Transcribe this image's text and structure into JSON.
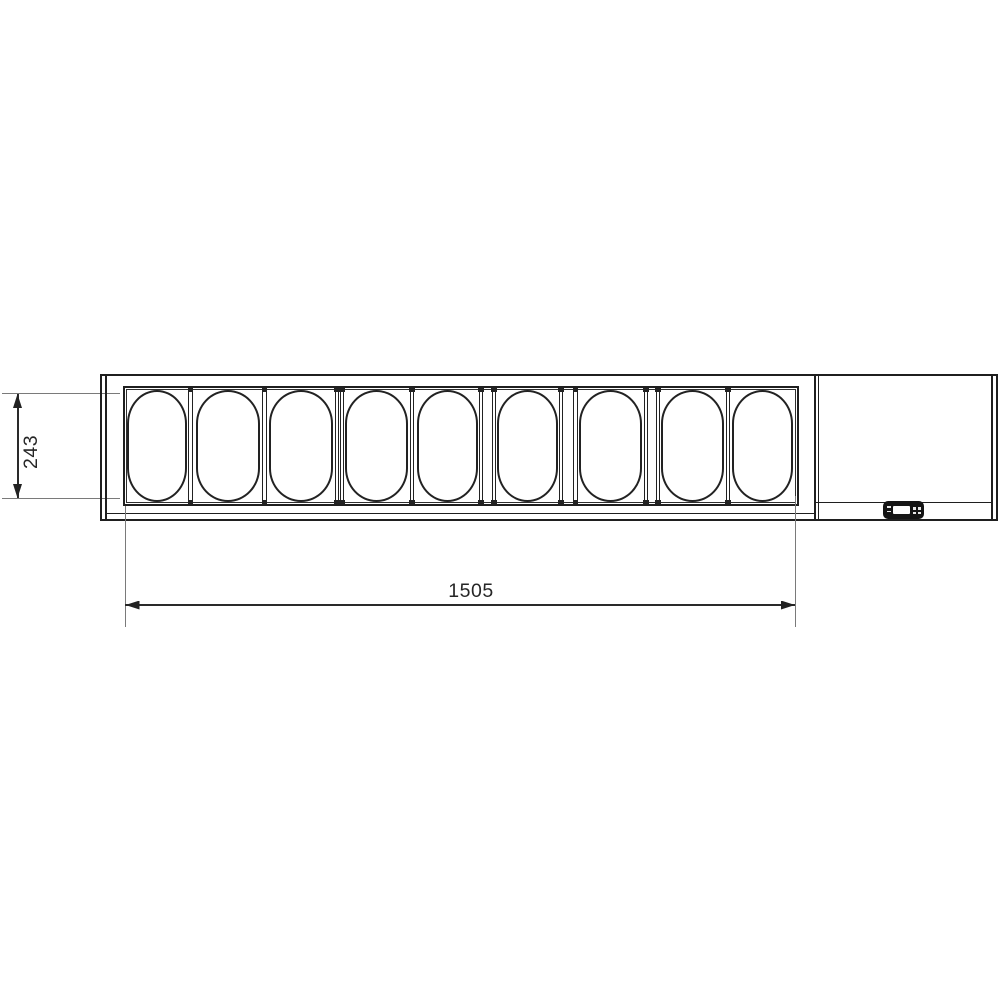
{
  "drawing": {
    "dimensions": {
      "width_label": "1505",
      "depth_label": "243"
    },
    "pans": {
      "count": 9
    },
    "controller": {
      "description": "digital-thermostat-controller"
    },
    "colors": {
      "line": "#1f1f1f",
      "dimension_line": "#2a2a2a",
      "extension_line": "#7a7a7a",
      "controller_body": "#141414",
      "background": "#ffffff"
    }
  }
}
